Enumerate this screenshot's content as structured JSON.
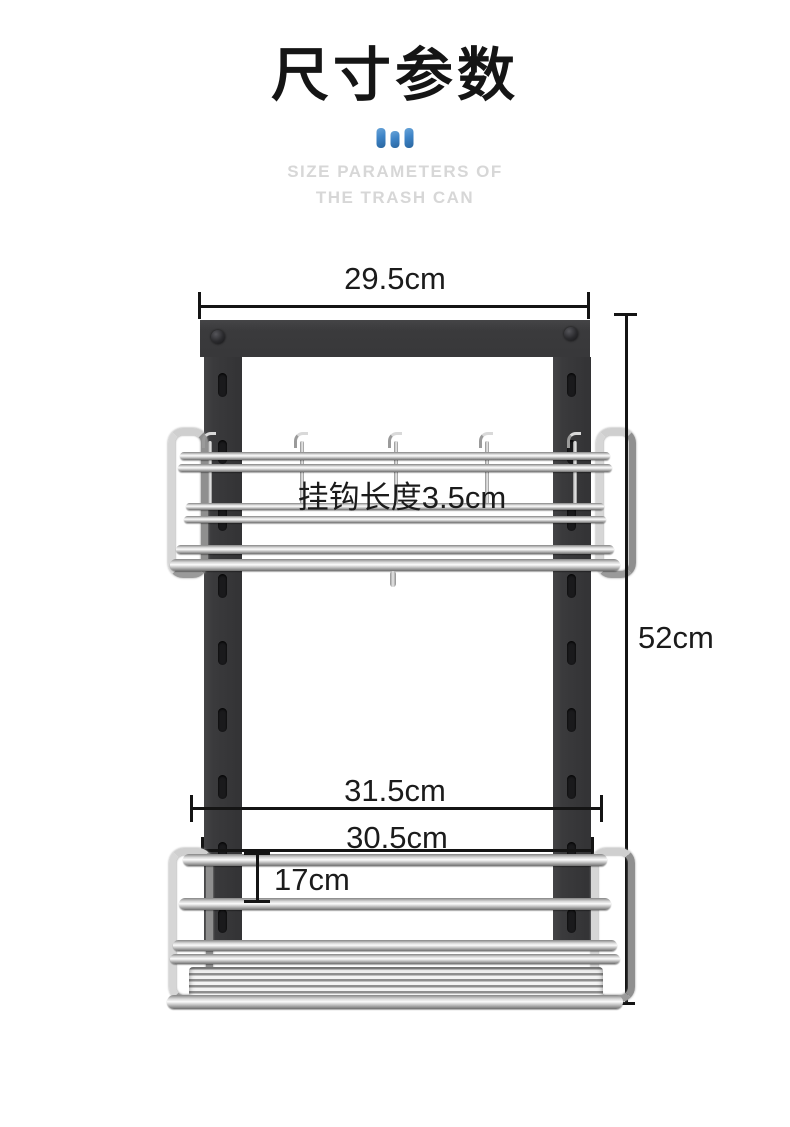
{
  "page": {
    "background": "#ffffff"
  },
  "header": {
    "title": "尺寸参数",
    "accent_icon": "three-bars-icon",
    "accent_color": "#3e84c7",
    "subtitle_line1": "SIZE PARAMETERS OF",
    "subtitle_line2": "THE TRASH CAN",
    "subtitle_color": "#d7d7d7"
  },
  "annotations": {
    "top_width": "29.5cm",
    "hook_length": "挂钩长度3.5cm",
    "total_height": "52cm",
    "outer_width": "31.5cm",
    "basket_width": "30.5cm",
    "basket_height": "17cm"
  },
  "product": {
    "frame_color": "#3a3a3c",
    "chrome_color": "#c6c6c6",
    "slot_color": "#1a1a1c"
  }
}
